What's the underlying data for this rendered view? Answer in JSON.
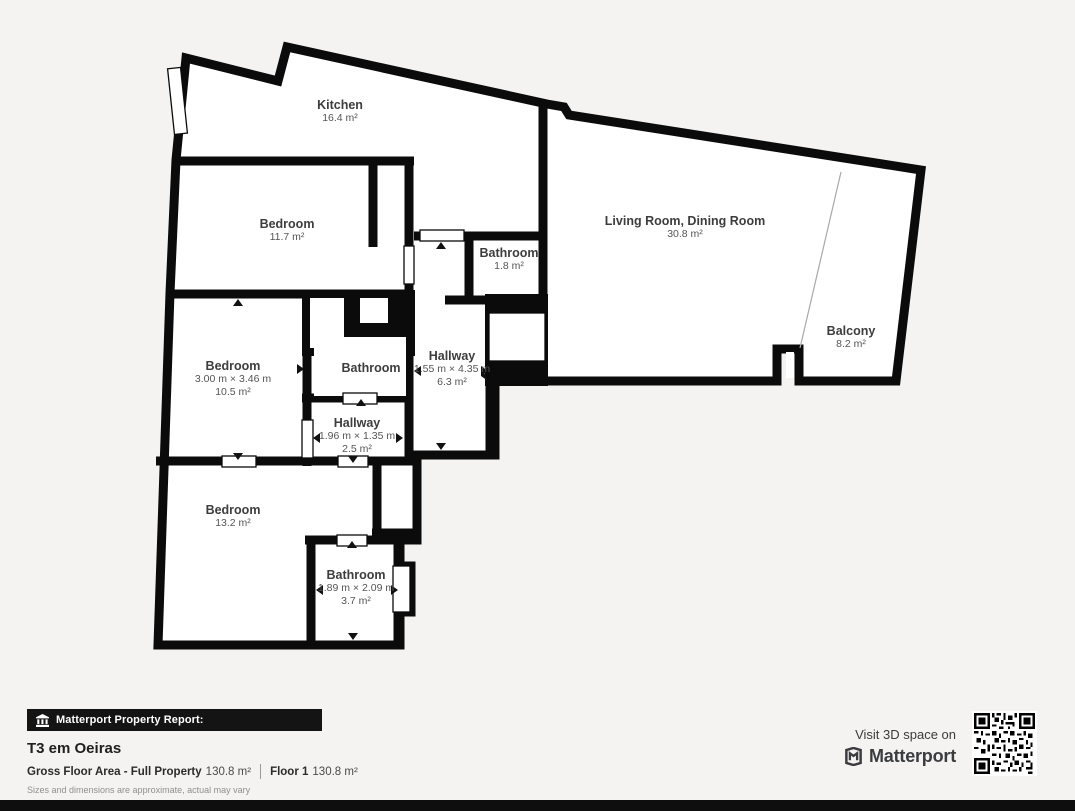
{
  "rooms": [
    {
      "name": "Kitchen",
      "area": "16.4 m²"
    },
    {
      "name": "Bedroom",
      "area": "11.7 m²"
    },
    {
      "name": "Living Room, Dining Room",
      "area": "30.8 m²"
    },
    {
      "name": "Bathroom",
      "area": "1.8 m²"
    },
    {
      "name": "Balcony",
      "area": "8.2 m²"
    },
    {
      "name": "Bedroom",
      "dims": "3.00 m × 3.46 m",
      "area": "10.5 m²"
    },
    {
      "name": "Bathroom"
    },
    {
      "name": "Hallway",
      "dims": "1.55 m × 4.35 m",
      "area": "6.3 m²"
    },
    {
      "name": "Hallway",
      "dims": "1.96 m × 1.35 m",
      "area": "2.5 m²"
    },
    {
      "name": "Bedroom",
      "area": "13.2 m²"
    },
    {
      "name": "Bathroom",
      "dims": "1.89 m × 2.09 m",
      "area": "3.7 m²"
    }
  ],
  "footer": {
    "report_label": "Matterport Property Report:",
    "property_title": "T3 em Oeiras",
    "gfa_label": "Gross Floor Area - Full Property",
    "gfa_value": "130.8 m²",
    "floor_label": "Floor 1",
    "floor_value": "130.8 m²",
    "disclaimer": "Sizes and dimensions are approximate, actual may vary"
  },
  "cta": {
    "visit_label": "Visit 3D space on",
    "brand": "Matterport"
  },
  "colors": {
    "wall": "#0b0b0b",
    "background": "#f4f3f1",
    "room_fill": "#ffffff"
  }
}
